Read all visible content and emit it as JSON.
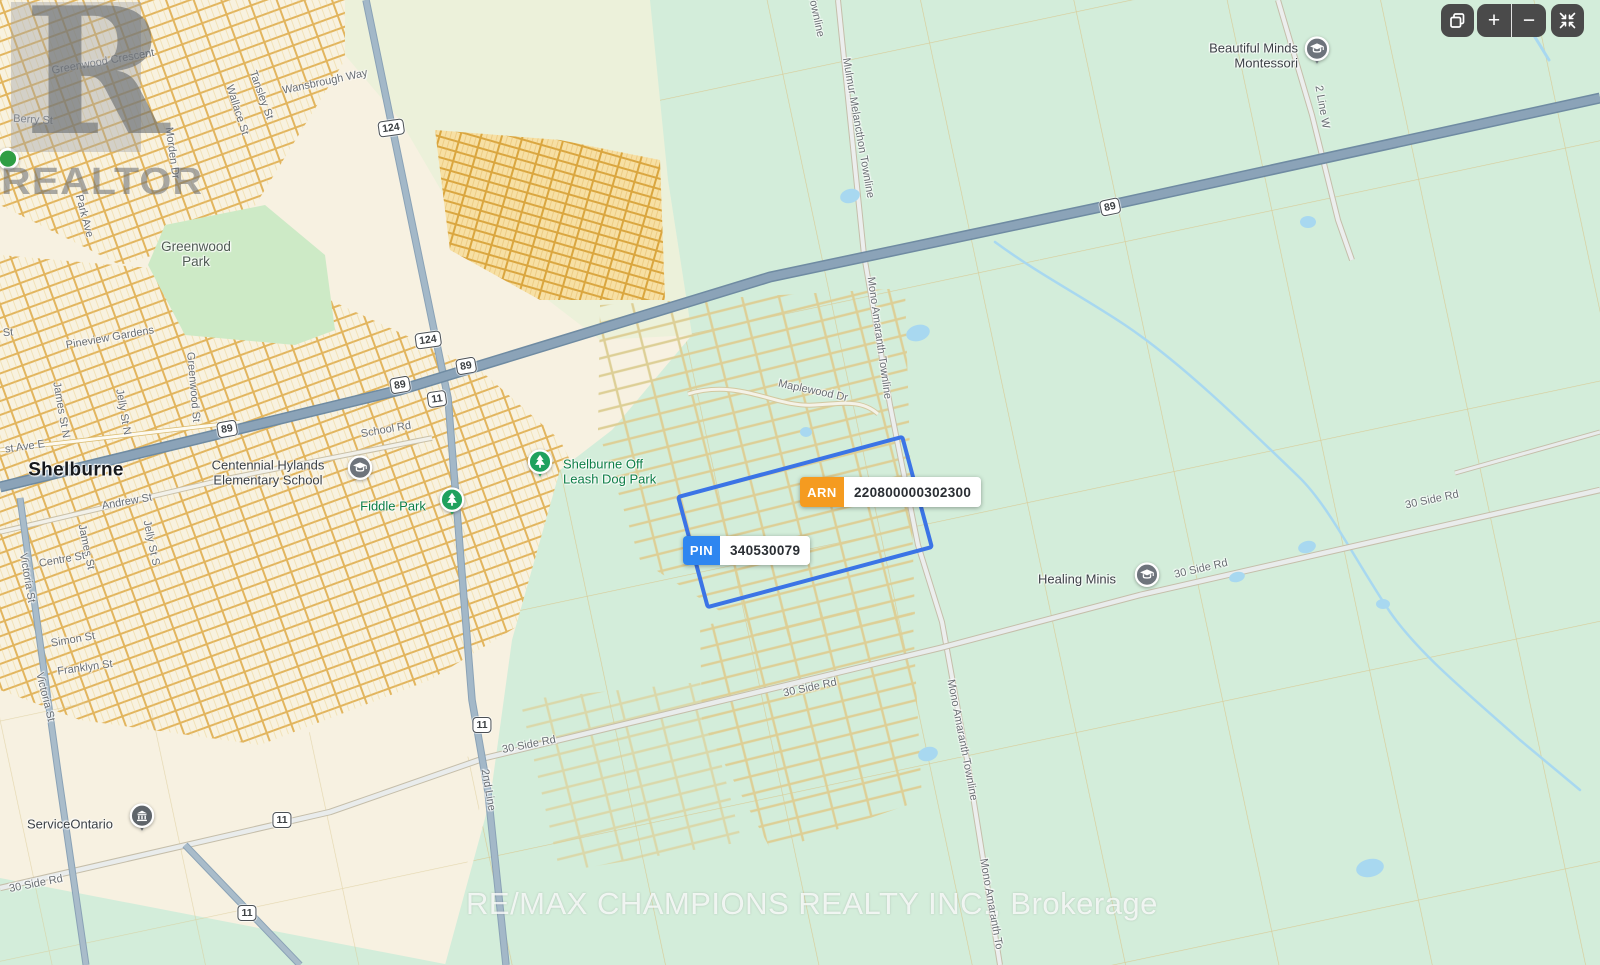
{
  "watermarks": {
    "logo_letter": "R",
    "logo_wordmark": "REALTOR",
    "brokerage": "RE/MAX CHAMPIONS REALTY INC., Brokerage"
  },
  "controls": {
    "copy_icon": "copy",
    "zoom_in_label": "+",
    "zoom_out_label": "−",
    "collapse_icon": "collapse"
  },
  "property": {
    "arn_label": "ARN",
    "arn_value": "220800000302300",
    "pin_label": "PIN",
    "pin_value": "340530079"
  },
  "colors": {
    "arn_badge": "#f59b20",
    "pin_badge": "#2e86f0",
    "property_outline": "#3b74e6",
    "land_urban": "#f7f1e1",
    "land_rural": "#d3edda",
    "park_green": "#cdeac6",
    "highway": "#8ba3b8",
    "water": "#a8d8f0",
    "park_label_green": "#0d7e47"
  },
  "town_label": {
    "text": "Shelburne",
    "x": 76,
    "y": 470
  },
  "street_labels": [
    {
      "text": "Greenwood Crescent",
      "x": 103,
      "y": 62,
      "r": -10
    },
    {
      "text": "Berry St",
      "x": 33,
      "y": 120,
      "r": 3
    },
    {
      "text": "Wallace St",
      "x": 237,
      "y": 110,
      "r": 72
    },
    {
      "text": "Tansley St",
      "x": 261,
      "y": 95,
      "r": 70
    },
    {
      "text": "Wansbrough Way",
      "x": 325,
      "y": 82,
      "r": -12
    },
    {
      "text": "Morden Dr",
      "x": 172,
      "y": 153,
      "r": 82
    },
    {
      "text": "Park Ave",
      "x": 84,
      "y": 216,
      "r": 75
    },
    {
      "text": "Pineview Gardens",
      "x": 110,
      "y": 338,
      "r": -10
    },
    {
      "text": "St",
      "x": 8,
      "y": 333,
      "r": -5
    },
    {
      "text": "James St N",
      "x": 61,
      "y": 410,
      "r": 80
    },
    {
      "text": "Jelly St N",
      "x": 123,
      "y": 412,
      "r": 80
    },
    {
      "text": "Greenwood St",
      "x": 193,
      "y": 387,
      "r": 85
    },
    {
      "text": "st Ave E",
      "x": 25,
      "y": 447,
      "r": -8
    },
    {
      "text": "School Rd",
      "x": 386,
      "y": 430,
      "r": -10
    },
    {
      "text": "Andrew St",
      "x": 127,
      "y": 502,
      "r": -10
    },
    {
      "text": "James St",
      "x": 86,
      "y": 547,
      "r": 78
    },
    {
      "text": "Jelly St S",
      "x": 151,
      "y": 543,
      "r": 78
    },
    {
      "text": "Centre St",
      "x": 62,
      "y": 560,
      "r": -10
    },
    {
      "text": "Victoria St",
      "x": 27,
      "y": 578,
      "r": 80
    },
    {
      "text": "Simon St",
      "x": 73,
      "y": 640,
      "r": -10
    },
    {
      "text": "Franklyn St",
      "x": 85,
      "y": 668,
      "r": -8
    },
    {
      "text": "Victoria St",
      "x": 45,
      "y": 697,
      "r": 76
    },
    {
      "text": "2nd Line",
      "x": 488,
      "y": 790,
      "r": 80
    },
    {
      "text": "30 Side Rd",
      "x": 36,
      "y": 884,
      "r": -11
    },
    {
      "text": "30 Side Rd",
      "x": 529,
      "y": 745,
      "r": -11
    },
    {
      "text": "30 Side Rd",
      "x": 810,
      "y": 688,
      "r": -12
    },
    {
      "text": "30 Side Rd",
      "x": 1201,
      "y": 569,
      "r": -13
    },
    {
      "text": "30 Side Rd",
      "x": 1432,
      "y": 500,
      "r": -12
    },
    {
      "text": "Townline",
      "x": 816,
      "y": 16,
      "r": 78
    },
    {
      "text": "Mulmur Melancthon Townline",
      "x": 858,
      "y": 128,
      "r": 80
    },
    {
      "text": "Mono Amaranth Townline",
      "x": 879,
      "y": 338,
      "r": 82
    },
    {
      "text": "Maplewood Dr",
      "x": 813,
      "y": 391,
      "r": 12
    },
    {
      "text": "Mono Amaranth Townline",
      "x": 962,
      "y": 740,
      "r": 79
    },
    {
      "text": "Mono Amaranth To",
      "x": 991,
      "y": 904,
      "r": 80
    },
    {
      "text": "2 Line W",
      "x": 1322,
      "y": 107,
      "r": 80
    }
  ],
  "shields": [
    {
      "text": "124",
      "x": 391,
      "y": 128,
      "r": -8
    },
    {
      "text": "124",
      "x": 428,
      "y": 340,
      "r": -8
    },
    {
      "text": "89",
      "x": 466,
      "y": 366,
      "r": -10
    },
    {
      "text": "89",
      "x": 400,
      "y": 385,
      "r": -10
    },
    {
      "text": "11",
      "x": 437,
      "y": 399,
      "r": -8
    },
    {
      "text": "89",
      "x": 227,
      "y": 429,
      "r": -10
    },
    {
      "text": "89",
      "x": 1110,
      "y": 207,
      "r": -12
    },
    {
      "text": "11",
      "x": 482,
      "y": 725,
      "r": 0
    },
    {
      "text": "11",
      "x": 282,
      "y": 820,
      "r": 0
    },
    {
      "text": "11",
      "x": 247,
      "y": 913,
      "r": 0
    }
  ],
  "pois": [
    {
      "name": "greenwood-park",
      "text": "Greenwood\nPark",
      "x": 196,
      "y": 254,
      "cls": "lbl-area",
      "align": "center",
      "inter": false
    },
    {
      "name": "centennial-hylands-elementary-school",
      "text": "Centennial Hylands\nElementary School",
      "x": 268,
      "y": 473,
      "cls": "lbl-poi",
      "align": "center",
      "inter": true,
      "icon": {
        "type": "school",
        "x": 360,
        "y": 472
      }
    },
    {
      "name": "fiddle-park",
      "text": "Fiddle Park",
      "x": 393,
      "y": 507,
      "cls": "lbl-park",
      "align": "center",
      "inter": true,
      "icon": {
        "type": "tree-pin",
        "x": 452,
        "y": 504
      }
    },
    {
      "name": "shelburne-off-leash-dog-park",
      "text": "Shelburne Off\nLeash Dog Park",
      "x": 563,
      "y": 472,
      "cls": "lbl-park",
      "align": "left",
      "inter": true,
      "icon": {
        "type": "tree-pin",
        "x": 540,
        "y": 466
      }
    },
    {
      "name": "healing-minis",
      "text": "Healing Minis",
      "x": 1077,
      "y": 580,
      "cls": "lbl-poi",
      "align": "center",
      "inter": true,
      "icon": {
        "type": "school",
        "x": 1147,
        "y": 579
      }
    },
    {
      "name": "serviceontario",
      "text": "ServiceOntario",
      "x": 70,
      "y": 825,
      "cls": "lbl-poi",
      "align": "center",
      "inter": true,
      "icon": {
        "type": "building-pin",
        "x": 142,
        "y": 820
      }
    },
    {
      "name": "beautiful-minds-montessori",
      "text": "Beautiful Minds\nMontessori",
      "x": 1298,
      "y": 56,
      "cls": "lbl-poi",
      "align": "right",
      "inter": true,
      "icon": {
        "type": "school-pin",
        "x": 1317,
        "y": 53
      }
    },
    {
      "name": "park-marker",
      "text": "",
      "x": 8,
      "y": 163,
      "cls": "lbl-park",
      "align": "center",
      "inter": true,
      "icon": {
        "type": "dot",
        "x": 8,
        "y": 163
      }
    }
  ]
}
